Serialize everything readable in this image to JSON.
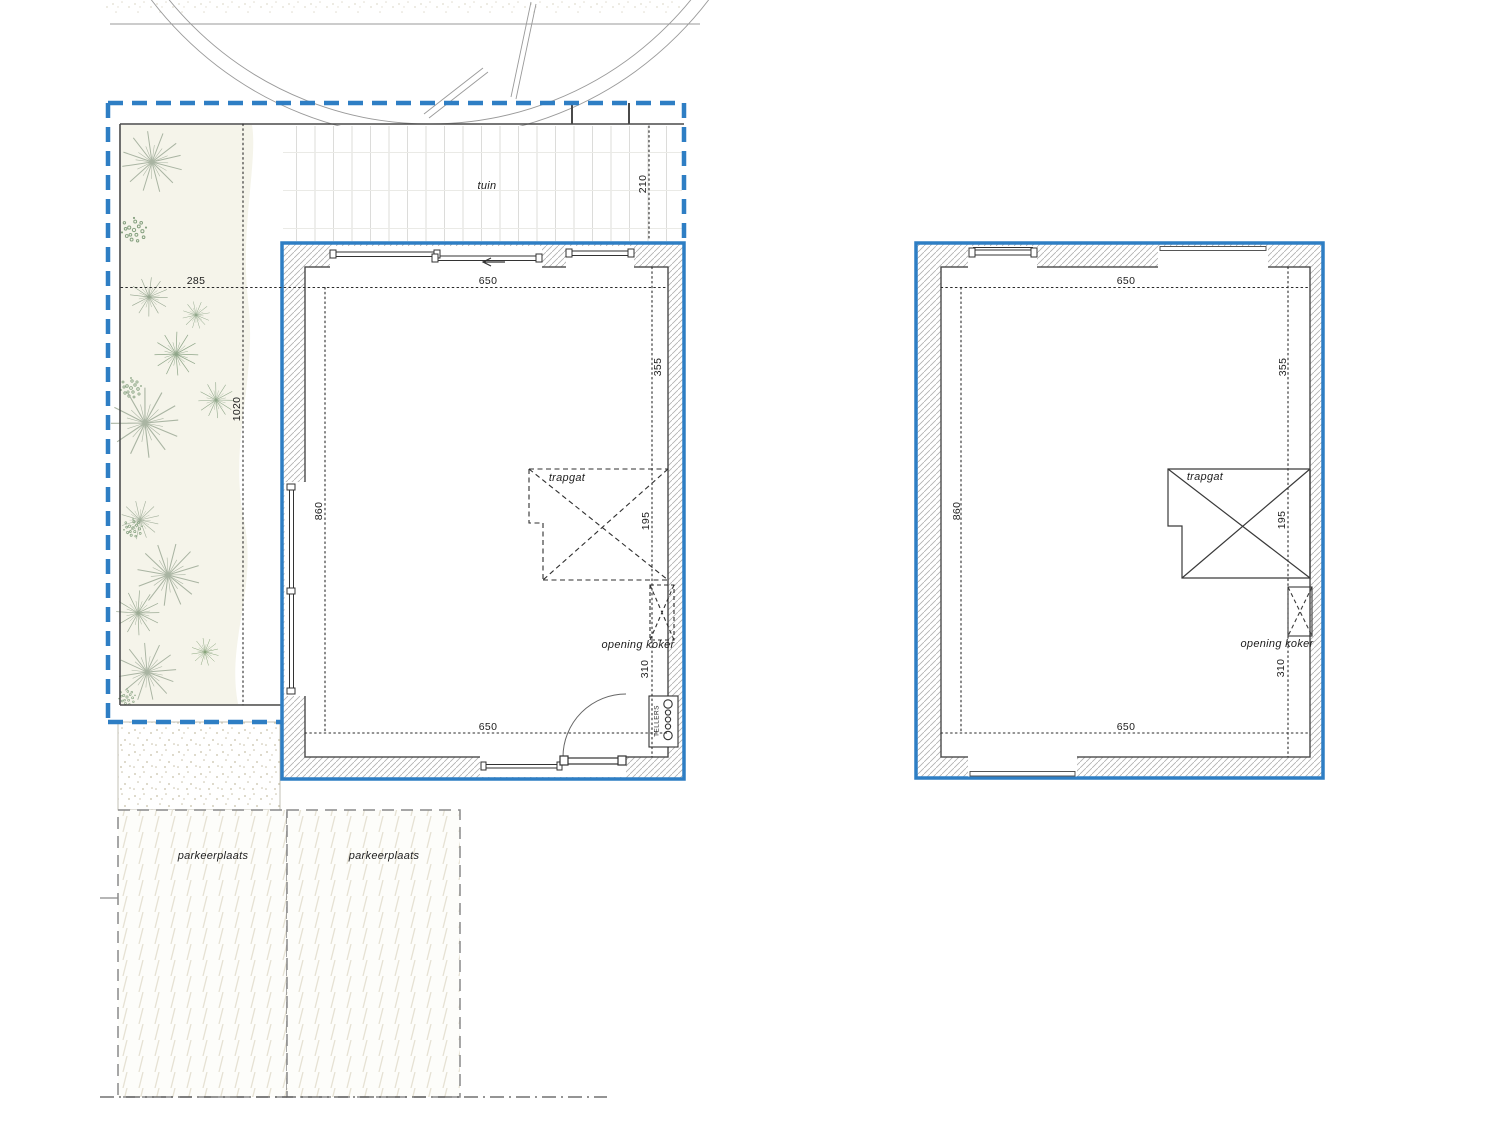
{
  "colors": {
    "boundary_blue": "#2e7ec4",
    "wall_outline": "#4a4a4a",
    "dim_line": "#2a2a2a",
    "plant_green": "#9db397",
    "shrub_green": "#85a07f",
    "garden_cream": "#f5f4ea"
  },
  "left_plan": {
    "name": "ground floor site plan",
    "garden_label": "tuin",
    "stair_label": "trapgat",
    "duct_label": "opening koker",
    "meters_label": "TELLERS",
    "parking_label_1": "parkeerplaats",
    "parking_label_2": "parkeerplaats",
    "dims": {
      "site_width": "285",
      "site_depth": "1020",
      "terrace_depth": "210",
      "width_top": "650",
      "height_left": "860",
      "right_upper": "355",
      "right_stair": "195",
      "right_lower": "310",
      "width_bottom": "650"
    }
  },
  "right_plan": {
    "name": "upper floor plan",
    "stair_label": "trapgat",
    "duct_label": "opening koker",
    "dims": {
      "width_top": "650",
      "height_left": "860",
      "right_upper": "355",
      "right_stair": "195",
      "right_lower": "310",
      "width_bottom": "650"
    }
  }
}
